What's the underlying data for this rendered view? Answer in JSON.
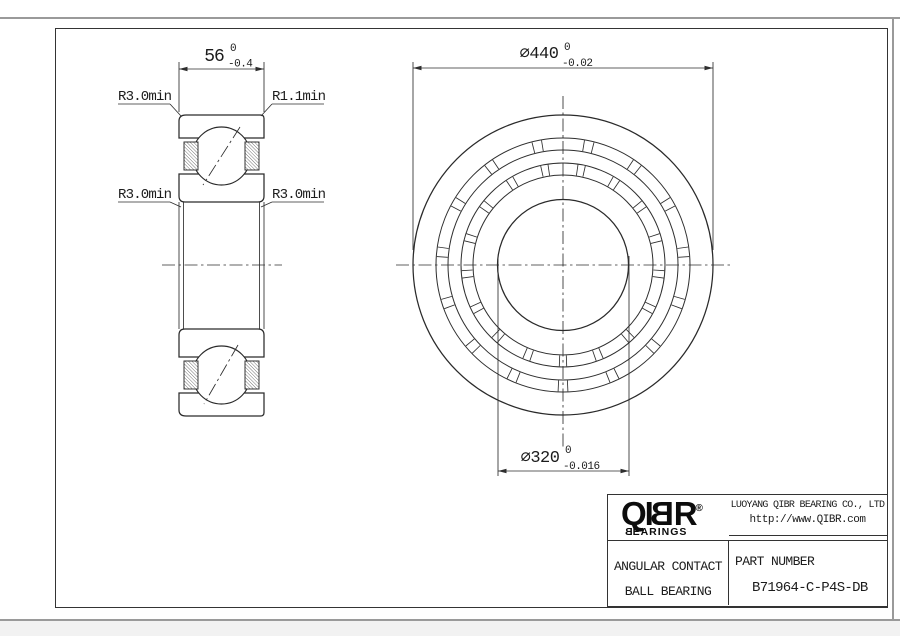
{
  "drawing": {
    "front_view": {
      "width_dim": {
        "value": "56",
        "tol_upper": "0",
        "tol_lower": "-0.4"
      },
      "labels": {
        "top_left": "R3.0min",
        "top_right": "R1.1min",
        "bottom_left": "R3.0min",
        "bottom_right": "R3.0min"
      }
    },
    "side_view": {
      "outer_dia": {
        "prefix": "∅",
        "value": "440",
        "tol_upper": "0",
        "tol_lower": "-0.02"
      },
      "bore_dia": {
        "prefix": "∅",
        "value": "320",
        "tol_upper": "0",
        "tol_lower": "-0.016"
      }
    }
  },
  "title_block": {
    "logo": {
      "left": "QI",
      "mirrored_b": "B",
      "right": "R",
      "registered": "®",
      "sub_first": "B",
      "sub_rest": "EARINGS"
    },
    "company": "LUOYANG QIBR BEARING CO., LTD",
    "website": "http://www.QIBR.com",
    "product_line1": "ANGULAR CONTACT",
    "product_line2": "BALL BEARING",
    "part_number_label": "PART NUMBER",
    "part_number": "B71964-C-P4S-DB"
  },
  "colors": {
    "line": "#2e2e2e",
    "frame": "#343434",
    "page_edge": "#9a9a9a",
    "background": "#ffffff"
  }
}
